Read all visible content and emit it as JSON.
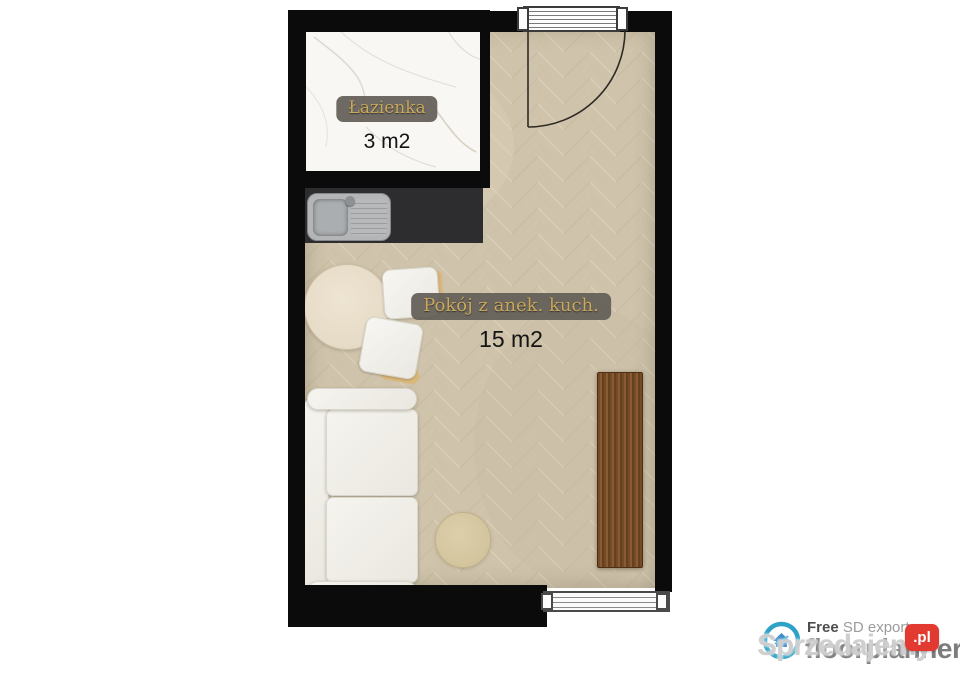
{
  "floor_plan": {
    "rooms": [
      {
        "id": "bathroom",
        "name_label": "Łazienka",
        "area_label": "3 m2",
        "floor_type": "white-marble"
      },
      {
        "id": "main-room",
        "name_label": "Pokój z anek. kuch.",
        "area_label": "15 m2",
        "floor_type": "herringbone-parquet"
      }
    ],
    "furniture": [
      "kitchen-counter-with-sink",
      "sofa",
      "round-table",
      "dining-chair",
      "dining-chair",
      "pouf-rug",
      "wooden-desk"
    ],
    "openings": [
      "entry-door-top",
      "window-bottom"
    ],
    "colors": {
      "wall": "#0b0b0b",
      "parquet_base": "#cdc1a9",
      "marble": "#f8f7f4",
      "counter": "#2d2c2e",
      "sink": "#b3b5b6",
      "badge_bg": "#635f57",
      "badge_gold_text": "#c9a75c",
      "sofa": "#f2f0ea",
      "table": "#e7ddc9",
      "pouf": "#d7c9a2",
      "desk_wood": "#754a27"
    }
  },
  "footer": {
    "free_label": "Free",
    "export_label": "SD export",
    "brand": "floorplanner",
    "logo": "floorplanner-logo-icon",
    "watermark_text": "Sprzedajemy",
    "watermark_badge": ".pl",
    "badge_color": "#e23a31"
  }
}
